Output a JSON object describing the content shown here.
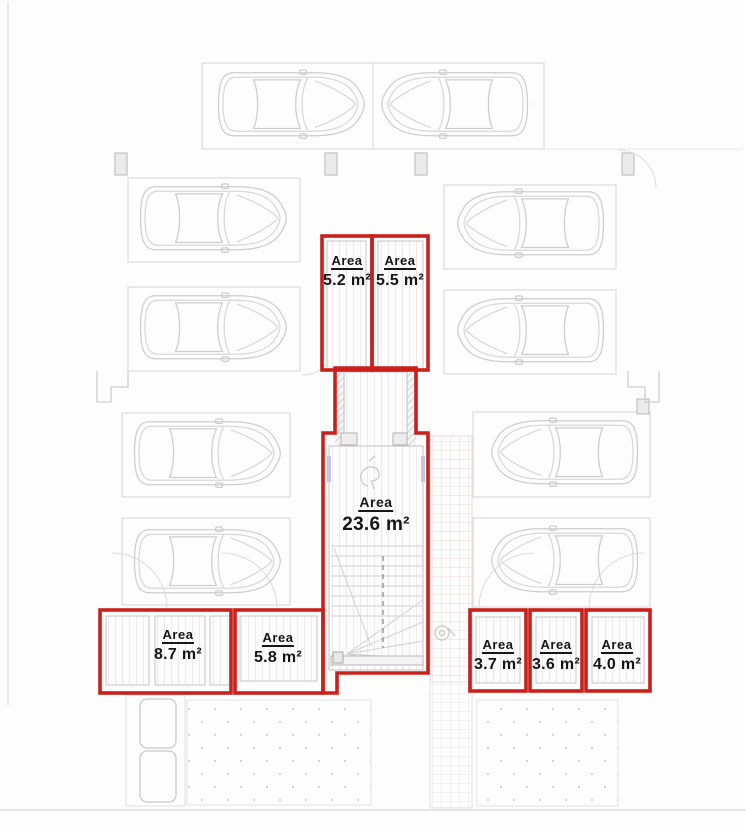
{
  "plan": {
    "accent_color": "#cb201a",
    "line_color": "#d8d8d8",
    "text_color": "#161616",
    "units": [
      {
        "name": "storage-top-left",
        "label": "Area",
        "value": "5.2 m²"
      },
      {
        "name": "storage-top-right",
        "label": "Area",
        "value": "5.5 m²"
      },
      {
        "name": "stairwell",
        "label": "Area",
        "value": "23.6 m²"
      },
      {
        "name": "storage-bottom-left-1",
        "label": "Area",
        "value": "8.7 m²"
      },
      {
        "name": "storage-bottom-left-2",
        "label": "Area",
        "value": "5.8 m²"
      },
      {
        "name": "storage-bottom-right-1",
        "label": "Area",
        "value": "3.7 m²"
      },
      {
        "name": "storage-bottom-right-2",
        "label": "Area",
        "value": "3.6 m²"
      },
      {
        "name": "storage-bottom-right-3",
        "label": "Area",
        "value": "4.0 m²"
      }
    ]
  }
}
